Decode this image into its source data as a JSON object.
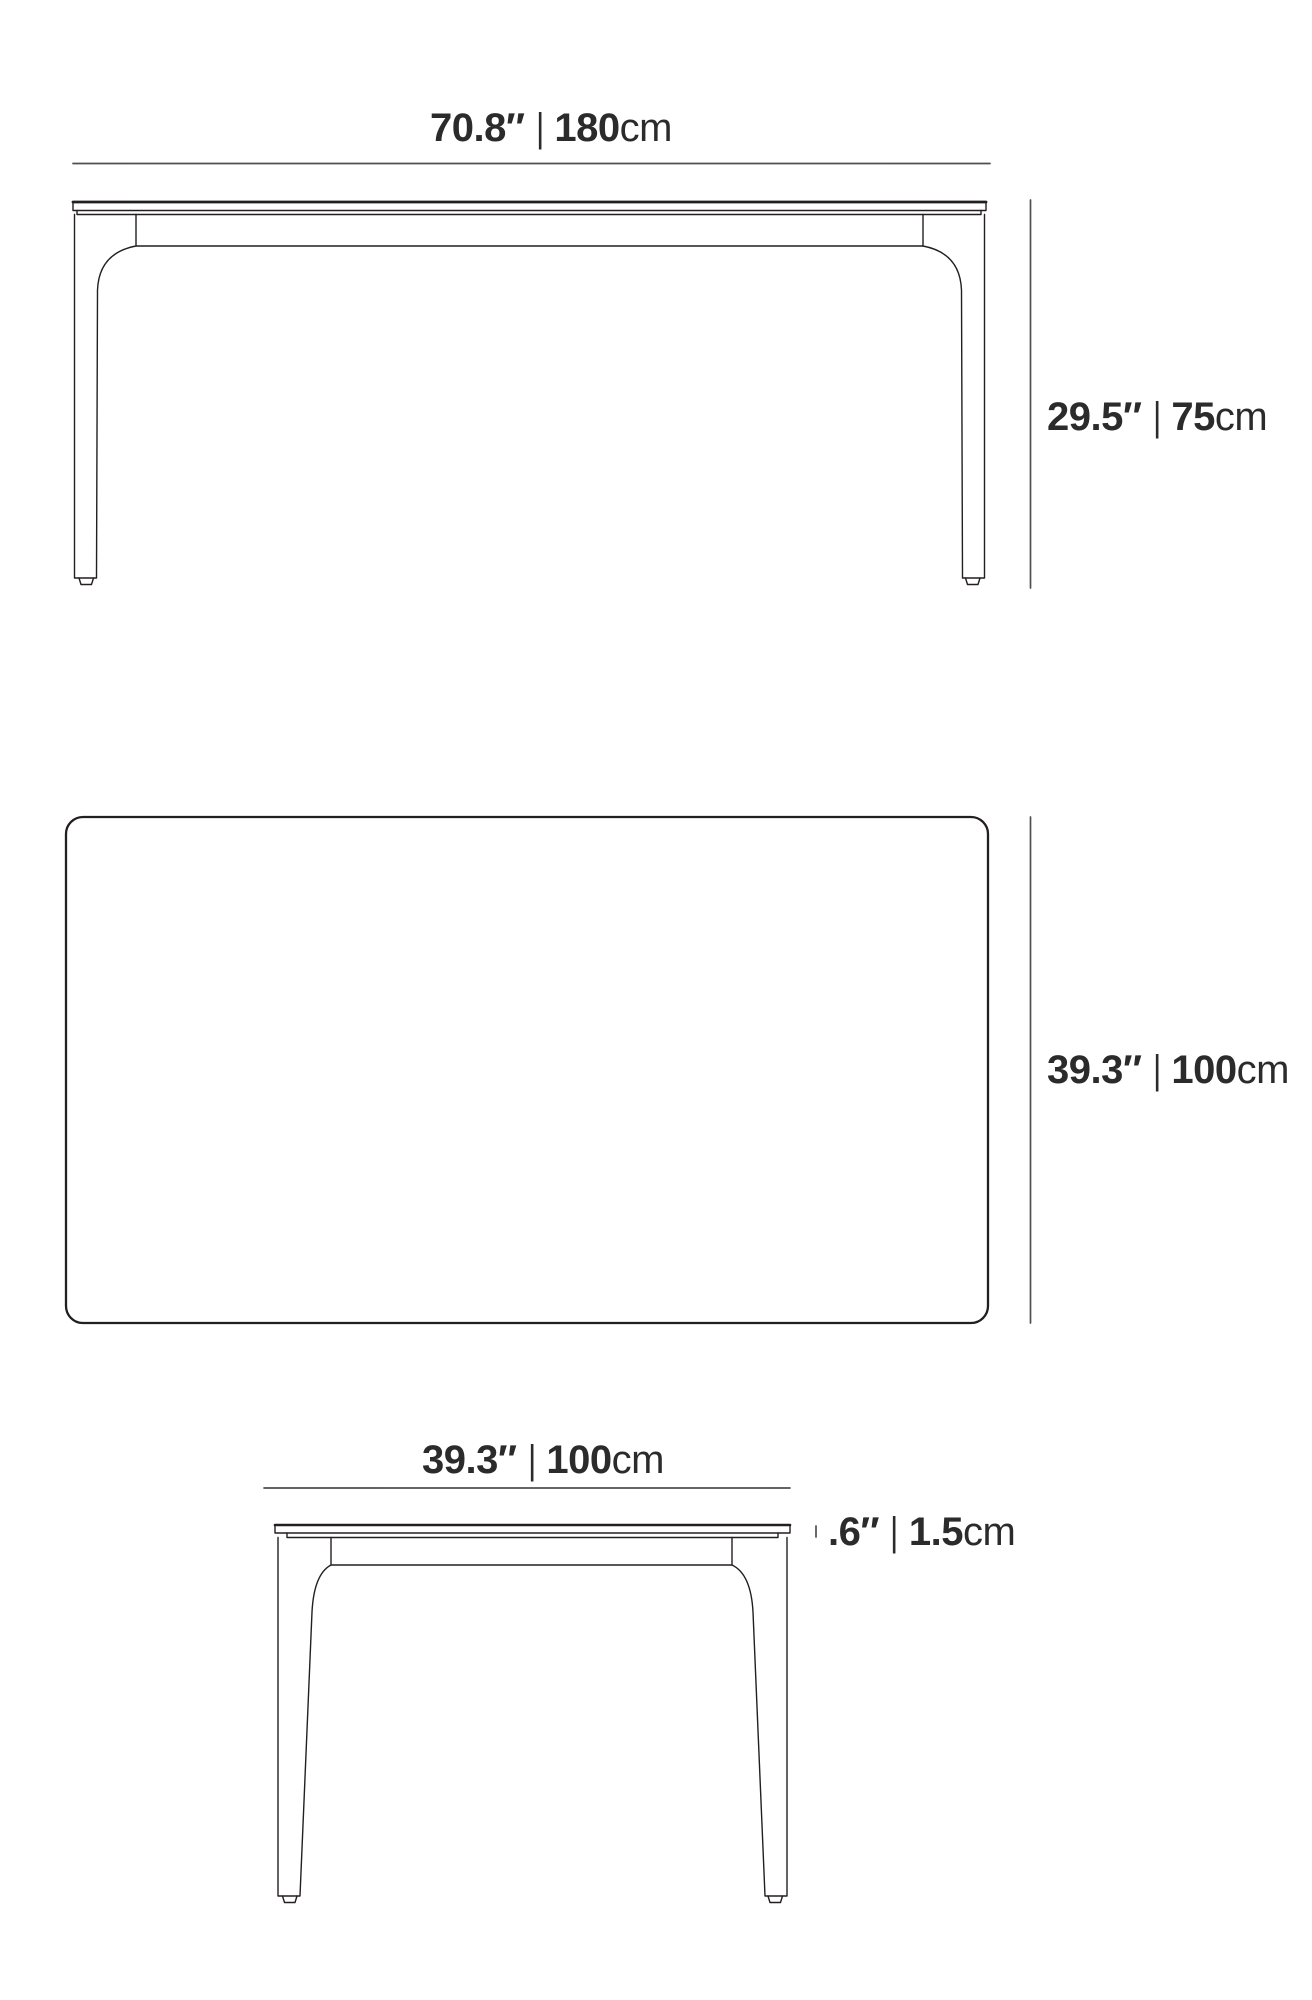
{
  "front_view": {
    "width_label": {
      "inches": "70.8″",
      "separator": "|",
      "cm_value": "180",
      "cm_unit": "cm"
    },
    "height_label": {
      "inches": "29.5″",
      "separator": "|",
      "cm_value": "75",
      "cm_unit": "cm"
    }
  },
  "top_view": {
    "depth_label": {
      "inches": "39.3″",
      "separator": "|",
      "cm_value": "100",
      "cm_unit": "cm"
    }
  },
  "side_view": {
    "width_label": {
      "inches": "39.3″",
      "separator": "|",
      "cm_value": "100",
      "cm_unit": "cm"
    },
    "thickness_label": {
      "inches": ".6″",
      "separator": "|",
      "cm_value": "1.5",
      "cm_unit": "cm"
    }
  },
  "colors": {
    "outline": "#231f20",
    "dimension_line": "#4f4f4f",
    "text": "#2b2b2b",
    "background": "#ffffff"
  }
}
